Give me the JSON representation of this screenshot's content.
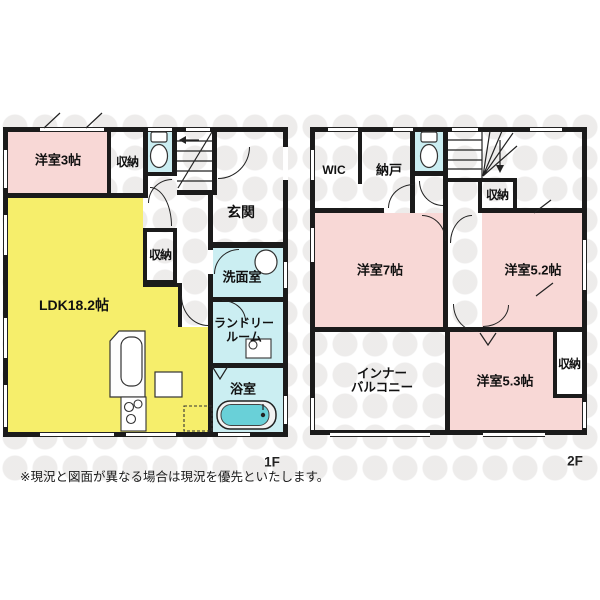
{
  "disclaimer": "※現況と図面が異なる場合は現況を優先といたします。",
  "colors": {
    "room_pink": "#f8d8d6",
    "room_yellow": "#f6ee6b",
    "room_cyan": "#cbeef2",
    "bathtub_teal": "#69d0d8",
    "wall_black": "#1b1b1b"
  },
  "floor1": {
    "label": "1F",
    "rooms": {
      "bedroom3": "洋室3帖",
      "closet_top": "収納",
      "entrance": "玄関",
      "closet_mid": "収納",
      "ldk": "LDK18.2帖",
      "washroom": "洗面室",
      "laundry1": "ランドリー",
      "laundry2": "ルーム",
      "bathroom": "浴室"
    }
  },
  "floor2": {
    "label": "2F",
    "rooms": {
      "wic": "WIC",
      "storeroom": "納戸",
      "closet_top": "収納",
      "bedroom7": "洋室7帖",
      "bedroom52": "洋室5.2帖",
      "balcony1": "インナー",
      "balcony2": "バルコニー",
      "bedroom53": "洋室5.3帖",
      "closet_right": "収納"
    }
  }
}
